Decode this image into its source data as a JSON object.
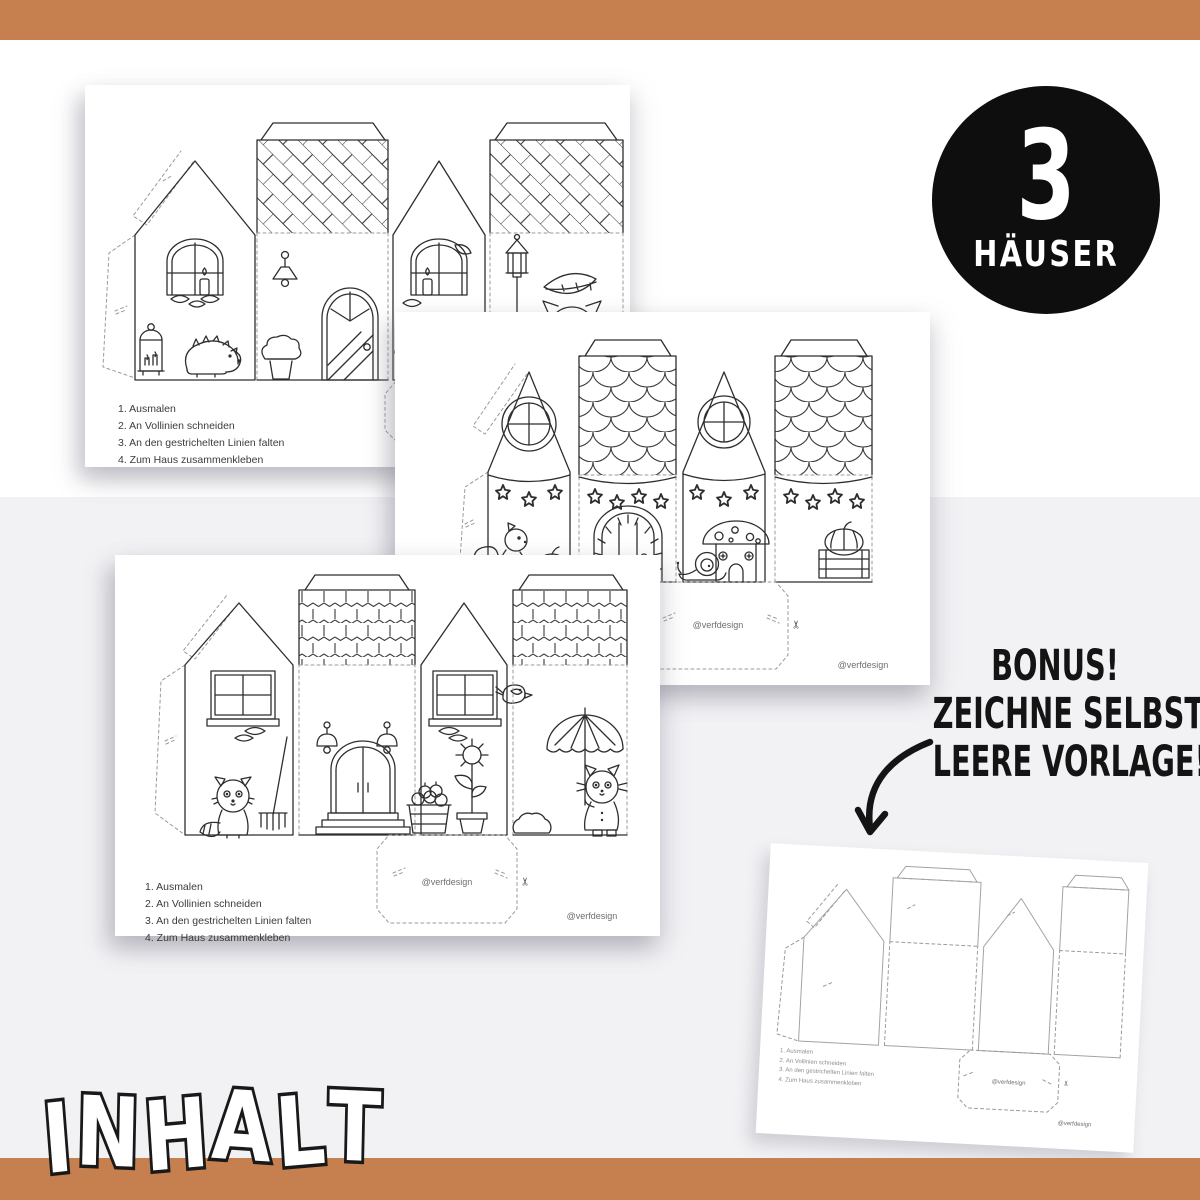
{
  "colors": {
    "accent_bar": "#C67F4E",
    "background_top": "#FFFFFF",
    "background_bottom": "#F2F1F4",
    "badge_bg": "#0E0E0E",
    "badge_text": "#FFFFFF",
    "ink": "#2E2E2E",
    "template_gray": "#A3A3A3"
  },
  "badge": {
    "number": "3",
    "label": "HÄUSER"
  },
  "bonus": {
    "lines": [
      "BONUS!",
      "ZEICHNE SELBST -",
      "LEERE VORLAGE!"
    ]
  },
  "footer": {
    "title": "INHALT"
  },
  "pages": {
    "instructions": [
      "1. Ausmalen",
      "2. An Vollinien schneiden",
      "3. An den gestrichelten Linien falten",
      "4. Zum Haus zusammenkleben"
    ],
    "watermark": "@verfdesign"
  },
  "icons": {
    "scissors": "✂"
  }
}
